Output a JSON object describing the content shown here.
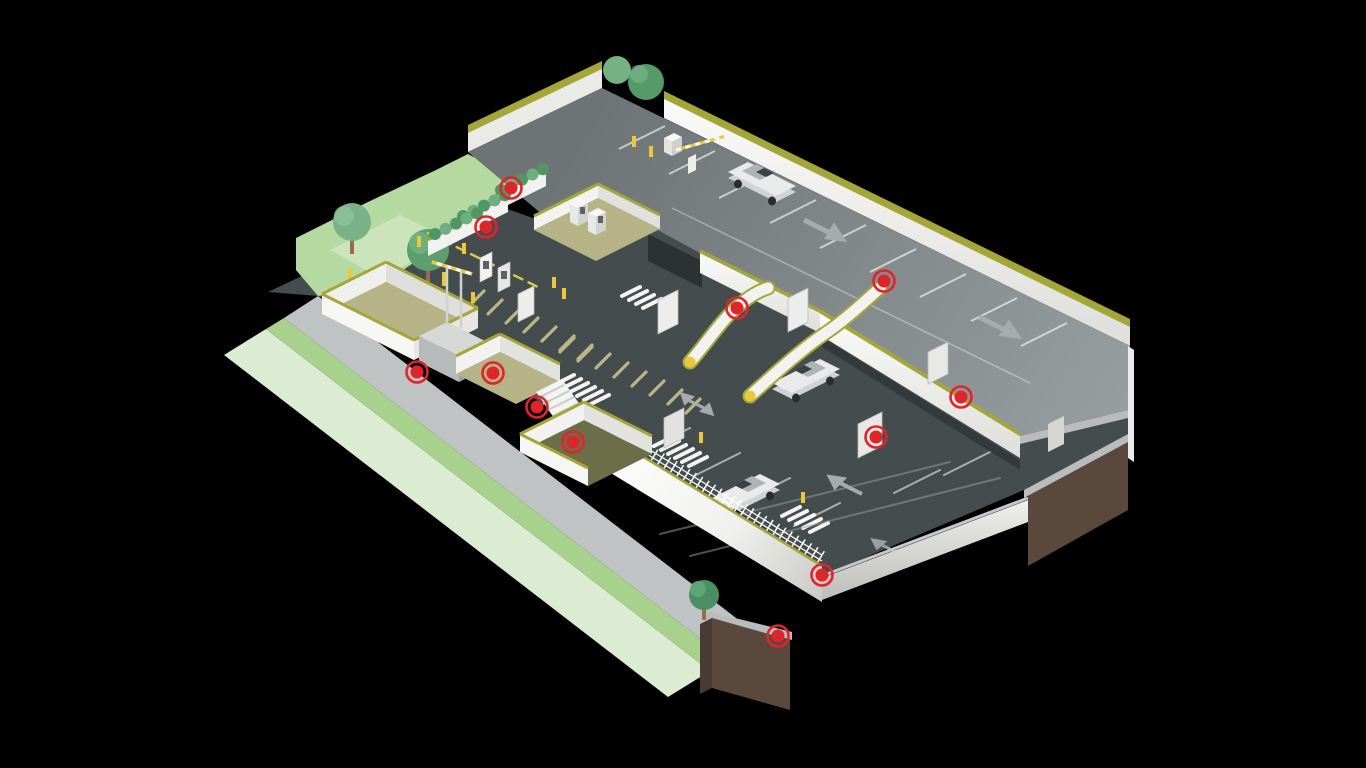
{
  "scene": {
    "title": "Isometric multi-level parking facility illustration",
    "background_color": "#000000",
    "palette": {
      "hotspot_red": "#e0242b",
      "olive_edge": "#a5a63a",
      "wall_white": "#f2f2f0",
      "deck_gray": "#7e8487",
      "lower_level_gray": "#454c4e",
      "road_gray": "#c0c3c4",
      "grass_pale": "#dcecd3",
      "grass_bright": "#a7d18c",
      "hill_green": "#b5daa1",
      "khaki_floor": "#b6b387",
      "moss_floor": "#6c6d49",
      "earth_brown": "#5a483d",
      "bollard_yellow": "#e9c93a",
      "tree_green": "#5d9e6e",
      "car_white": "#e9ebeb",
      "arrow_gray": "#a6acae"
    },
    "objects": [
      "top parking deck with car and barrier gate",
      "lower parking level with cars",
      "entrance lanes with ticket kiosks",
      "green-roofed canopies",
      "stairwell and elevator block",
      "pedestrian ramps with yellow tips",
      "perimeter walls with fence",
      "trees and grass verge",
      "earth foundation cutaway",
      "red hotspot markers"
    ]
  },
  "markers": [
    {
      "id": "hotspot-1",
      "x": 511,
      "y": 188
    },
    {
      "id": "hotspot-2",
      "x": 486,
      "y": 227
    },
    {
      "id": "hotspot-3",
      "x": 884,
      "y": 281
    },
    {
      "id": "hotspot-4",
      "x": 737,
      "y": 308
    },
    {
      "id": "hotspot-5",
      "x": 417,
      "y": 372
    },
    {
      "id": "hotspot-6",
      "x": 493,
      "y": 373
    },
    {
      "id": "hotspot-7",
      "x": 537,
      "y": 407
    },
    {
      "id": "hotspot-8",
      "x": 573,
      "y": 442
    },
    {
      "id": "hotspot-9",
      "x": 961,
      "y": 397
    },
    {
      "id": "hotspot-10",
      "x": 876,
      "y": 437
    },
    {
      "id": "hotspot-11",
      "x": 822,
      "y": 575
    },
    {
      "id": "hotspot-12",
      "x": 778,
      "y": 636
    }
  ],
  "marker_style": {
    "color": "#e0242b",
    "dot_radius": 6.5,
    "ring_radius": 10.5,
    "ring_width": 2.6
  }
}
